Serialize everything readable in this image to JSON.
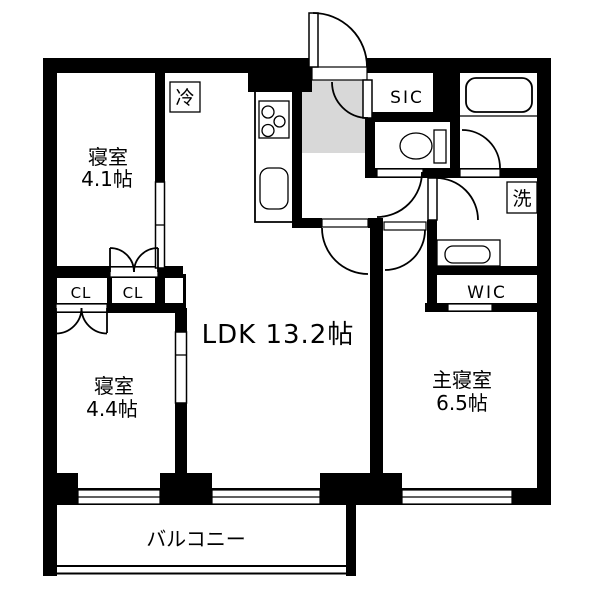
{
  "floorplan": {
    "colors": {
      "wall": "#000000",
      "floor": "#ffffff",
      "entry_floor_gray": "#d8d8d8"
    },
    "rooms": {
      "bedroom_top": {
        "name": "寝室",
        "size": "4.1帖"
      },
      "bedroom_bottom": {
        "name": "寝室",
        "size": "4.4帖"
      },
      "master_bedroom": {
        "name": "主寝室",
        "size": "6.5帖"
      },
      "ldk": {
        "label": "LDK 13.2帖"
      },
      "balcony": {
        "label": "バルコニー"
      },
      "shoe_closet": {
        "label": "SIC"
      },
      "walk_in_closet": {
        "label": "WIC"
      },
      "closet_left": {
        "label": "CL"
      },
      "closet_right": {
        "label": "CL"
      },
      "refrigerator_space": {
        "label": "冷"
      },
      "washer_space": {
        "label": "洗"
      }
    }
  }
}
